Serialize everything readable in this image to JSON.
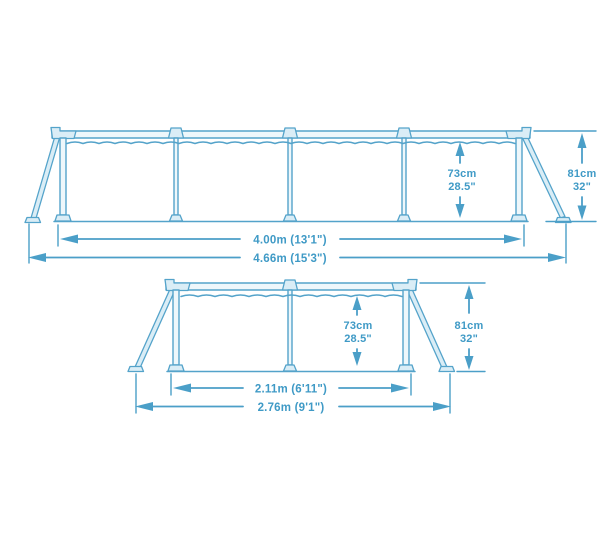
{
  "pool_diagram": {
    "description": "Rectangular steel frame pool dimension drawing, two elevations",
    "colors": {
      "line": "#54a3ca",
      "dimension_line": "#4b9fc8",
      "text": "#3f9ac6",
      "part_fill": "#daedf6",
      "background": "#ffffff"
    },
    "long_view": {
      "panels": 4,
      "inner_length": "4.00m (13'1\")",
      "outer_length": "4.66m (15'3\")",
      "water_height_cm": "73cm",
      "water_height_in": "28.5\"",
      "frame_height_cm": "81cm",
      "frame_height_in": "32\""
    },
    "short_view": {
      "panels": 2,
      "inner_length": "2.11m (6'11\")",
      "outer_length": "2.76m (9'1\")",
      "water_height_cm": "73cm",
      "water_height_in": "28.5\"",
      "frame_height_cm": "81cm",
      "frame_height_in": "32\""
    }
  }
}
